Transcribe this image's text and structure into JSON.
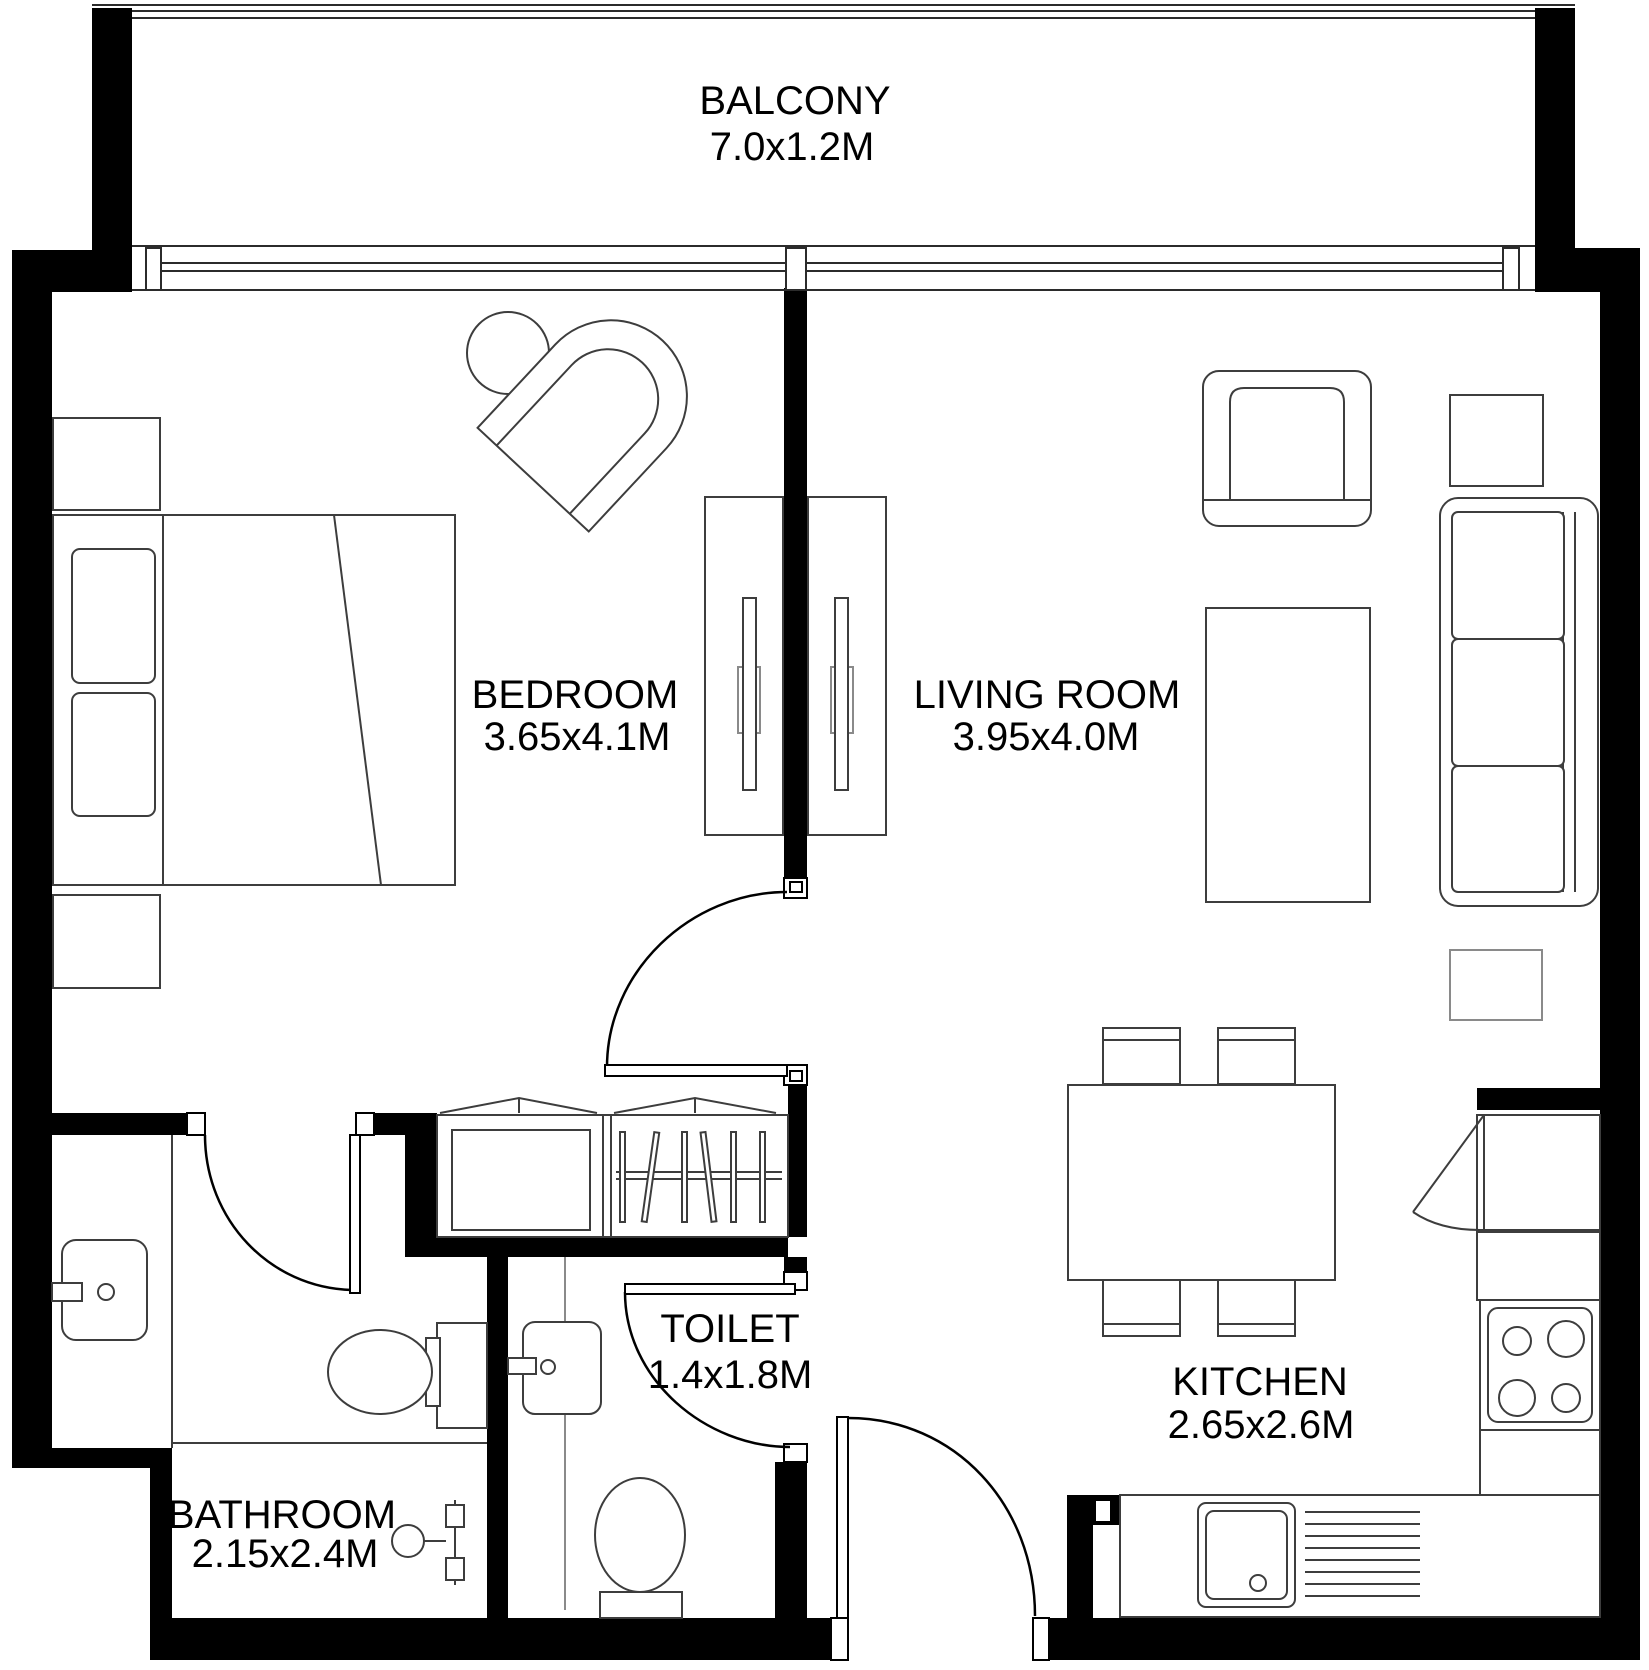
{
  "colors": {
    "walls": "#000000",
    "furniture_lines": "#3d3d3d",
    "light_lines": "#8a8a8a",
    "background": "#ffffff"
  },
  "rooms": {
    "balcony": {
      "name": "BALCONY",
      "dims": "7.0x1.2M"
    },
    "bedroom": {
      "name": "BEDROOM",
      "dims": "3.65x4.1M"
    },
    "living": {
      "name": "LIVING ROOM",
      "dims": "3.95x4.0M"
    },
    "toilet": {
      "name": "TOILET",
      "dims": "1.4x1.8M"
    },
    "bathroom": {
      "name": "BATHROOM",
      "dims": "2.15x2.4M"
    },
    "kitchen": {
      "name": "KITCHEN",
      "dims": "2.65x2.6M"
    }
  }
}
